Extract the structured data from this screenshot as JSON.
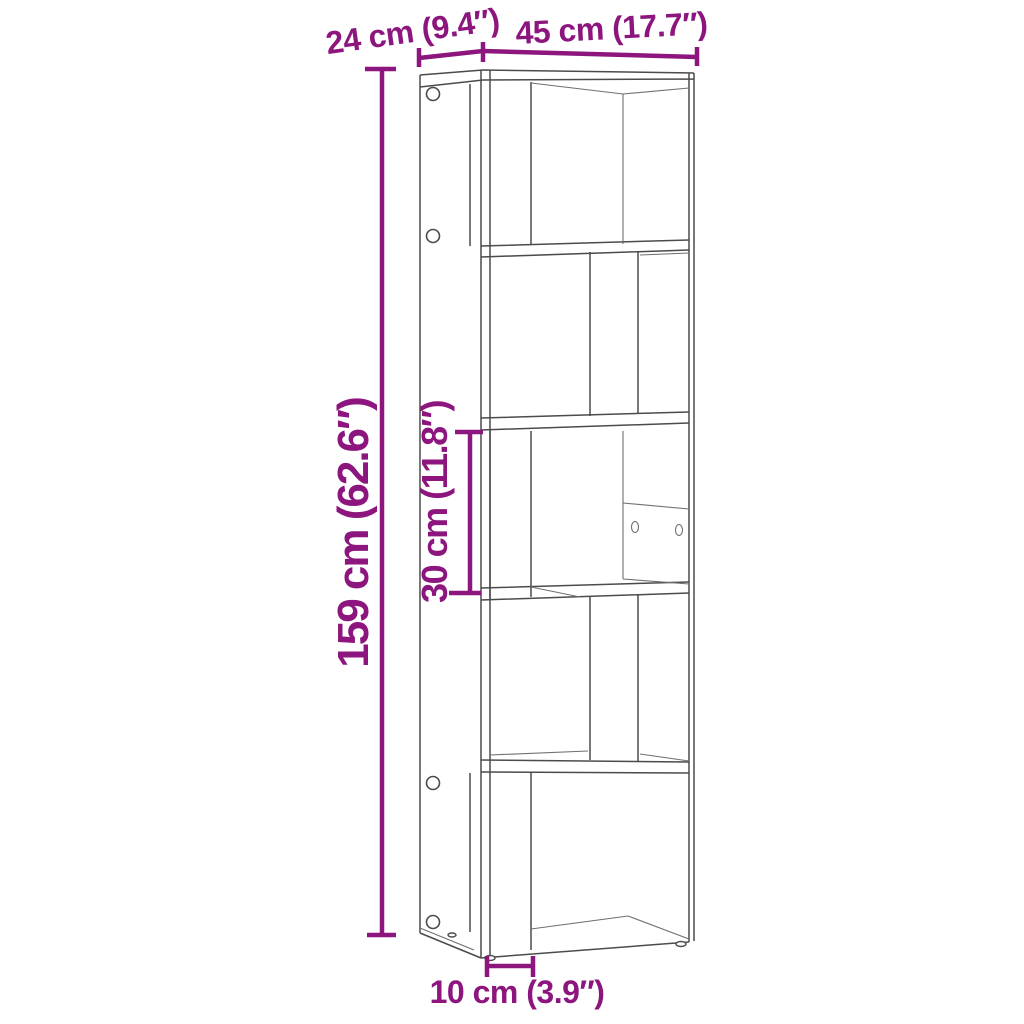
{
  "diagram": {
    "type": "furniture-dimension-diagram",
    "accent_color": "#8C157E",
    "line_color": "#4B4B4B",
    "background_color": "#FFFFFF",
    "labels": {
      "depth": "24 cm (9.4″)",
      "width": "45 cm (17.7″)",
      "height": "159 cm (62.6″)",
      "inner_height": "30 cm (11.8″)",
      "foot_inset": "10 cm (3.9″)"
    }
  }
}
